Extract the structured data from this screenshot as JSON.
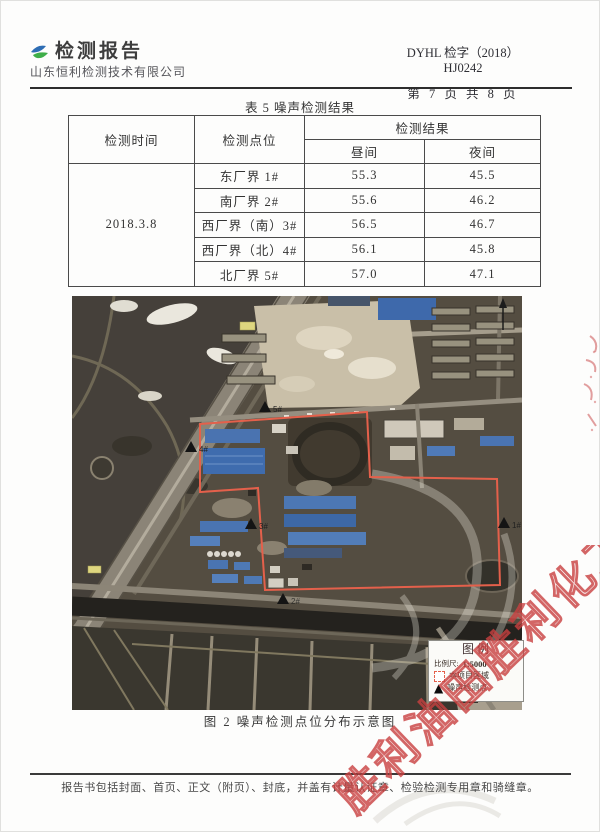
{
  "header": {
    "title": "检测报告",
    "company": "山东恒利检测技术有限公司",
    "report_no": "DYHL 检字（2018）HJ0242",
    "page_info": "第 7 页 共 8 页"
  },
  "table": {
    "title": "表 5 噪声检测结果",
    "headers": {
      "time": "检测时间",
      "point": "检测点位",
      "result": "检测结果",
      "day": "昼间",
      "night": "夜间"
    },
    "date": "2018.3.8",
    "rows": [
      {
        "point": "东厂界 1#",
        "day": "55.3",
        "night": "45.5"
      },
      {
        "point": "南厂界 2#",
        "day": "55.6",
        "night": "46.2"
      },
      {
        "point": "西厂界（南）3#",
        "day": "56.5",
        "night": "46.7"
      },
      {
        "point": "西厂界（北）4#",
        "day": "56.1",
        "night": "45.8"
      },
      {
        "point": "北厂界 5#",
        "day": "57.0",
        "night": "47.1"
      }
    ]
  },
  "map": {
    "points": [
      {
        "label": "5#"
      },
      {
        "label": "4#"
      },
      {
        "label": "3#"
      },
      {
        "label": "1#"
      },
      {
        "label": "2#"
      }
    ],
    "legend": {
      "title": "图例",
      "scale_label": "比例尺:",
      "scale_value": "1:5000",
      "area_label": "本项目区域",
      "point_label": "噪声检测点"
    },
    "caption": "图 2 噪声检测点位分布示意图"
  },
  "footer": {
    "note": "报告书包括封面、首页、正文（附页）、封底，并盖有计量认证章、检验检测专用章和骑缝章。"
  },
  "watermark": {
    "text": "胜利油田胜利化工",
    "color": "#c94040"
  },
  "colors": {
    "boundary_red": "#e4604b",
    "logo_blue": "#2e6db4",
    "logo_green": "#3fae49"
  }
}
